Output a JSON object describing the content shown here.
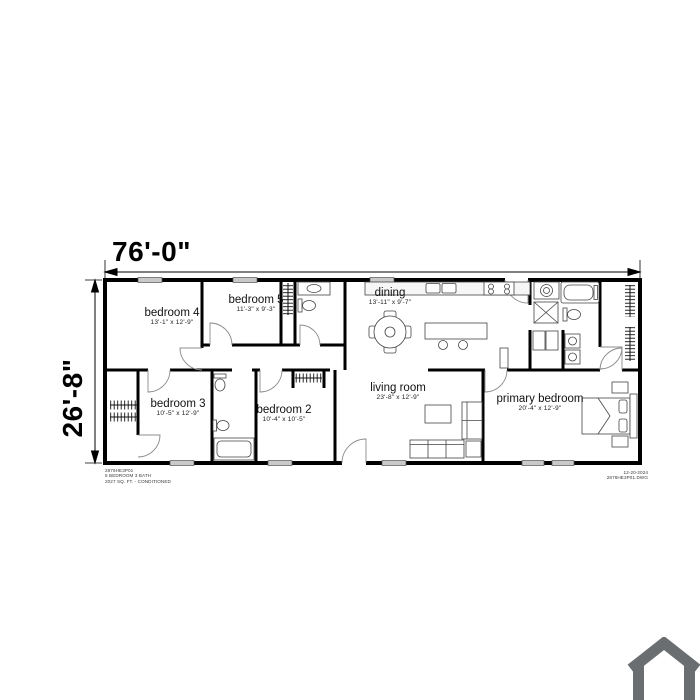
{
  "plan": {
    "width_label": "76'-0\"",
    "height_label": "26'-8\"",
    "rooms": [
      {
        "name": "bedroom 4",
        "size": "13'-1\" x 12'-9\""
      },
      {
        "name": "bedroom 5",
        "size": "11'-3\" x 9'-3\""
      },
      {
        "name": "dining",
        "size": "13'-11\" x 9'-7\""
      },
      {
        "name": "bedroom 3",
        "size": "10'-5\" x 12'-9\""
      },
      {
        "name": "bedroom 2",
        "size": "10'-4\" x 10'-5\""
      },
      {
        "name": "living room",
        "size": "23'-8\" x 12'-9\""
      },
      {
        "name": "primary bedroom",
        "size": "20'-4\" x 12'-9\""
      }
    ]
  },
  "title_block": {
    "model": "2876HE3P01",
    "description": "5 BEDROOM 3 BATH",
    "area": "2027 SQ. FT. - CONDITIONED",
    "date": "12-20-2024",
    "file": "2876HE3P01.DWG"
  },
  "watermark": {
    "color": "#6a6e70"
  }
}
